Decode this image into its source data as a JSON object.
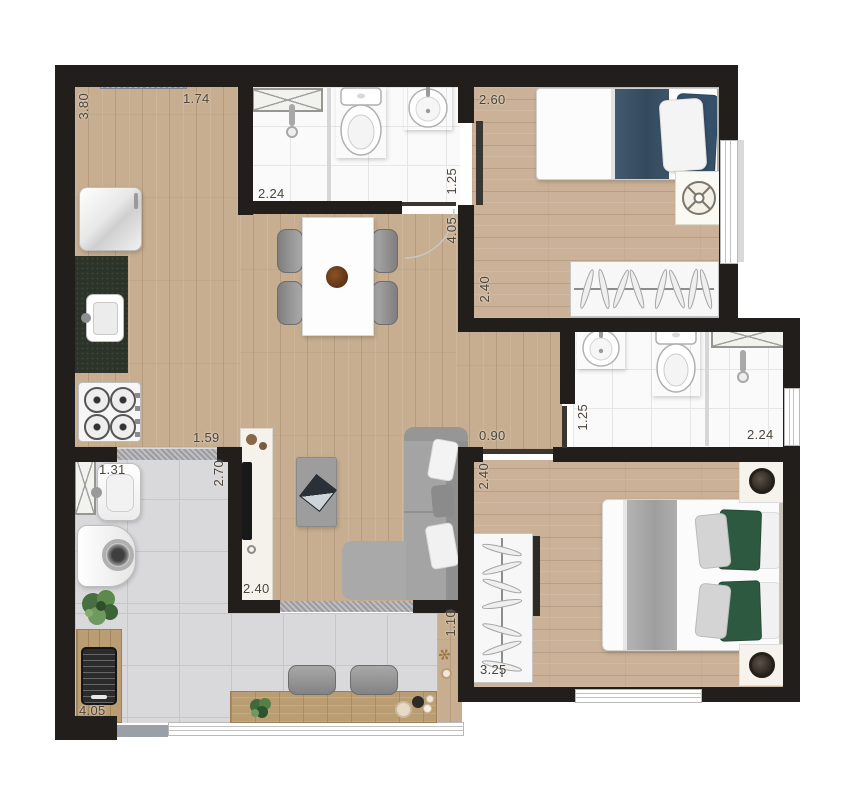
{
  "page": {
    "background": "#ffffff",
    "description": "Top-down rendered floor plan of a two-bedroom apartment with two bathrooms, kitchen, living-dining room, laundry area and balcony with grill and bar counter"
  },
  "colors": {
    "wall": "#211e1b",
    "wood_floor": "#c7ae90",
    "tile_floor": "#d9d9db",
    "bath_floor": "#fafafa",
    "entry_slab": "#98a1ae",
    "accent_navy": "#3d5469",
    "accent_green": "#2e5941",
    "sofa_gray": "#a2a2a2",
    "counter_dark": "#2c3329",
    "dimension_text": "#4c443a"
  },
  "dimensions": {
    "kitchen_height": "3.80",
    "kitchen_width": "1.74",
    "bath1_width": "2.24",
    "bath1_depth": "1.25",
    "bedroom1_width": "2.60",
    "hall_length": "4.05",
    "bedroom1_depth": "2.40",
    "kitchen_passage": "1.59",
    "hall_width": "0.90",
    "bath2_depth": "1.25",
    "bath2_width": "2.24",
    "bedroom2_depth": "2.40",
    "laundry_depth": "2.70",
    "laundry_width": "1.31",
    "living_width": "2.40",
    "bedroom2_width": "3.25",
    "balcony_depth": "1.10",
    "balcony_width": "4.05"
  },
  "icons": {
    "fan-icon": "circle with crossed blades",
    "shower-head-icon": "stem with head dot",
    "hanger-icon": "slanted hangers on rail",
    "plant-icon": "green foliage cluster",
    "lamp-icon": "dark ringed circle",
    "grill-icon": "dark grate rectangle",
    "burner-icon": "ringed circle with cross"
  }
}
